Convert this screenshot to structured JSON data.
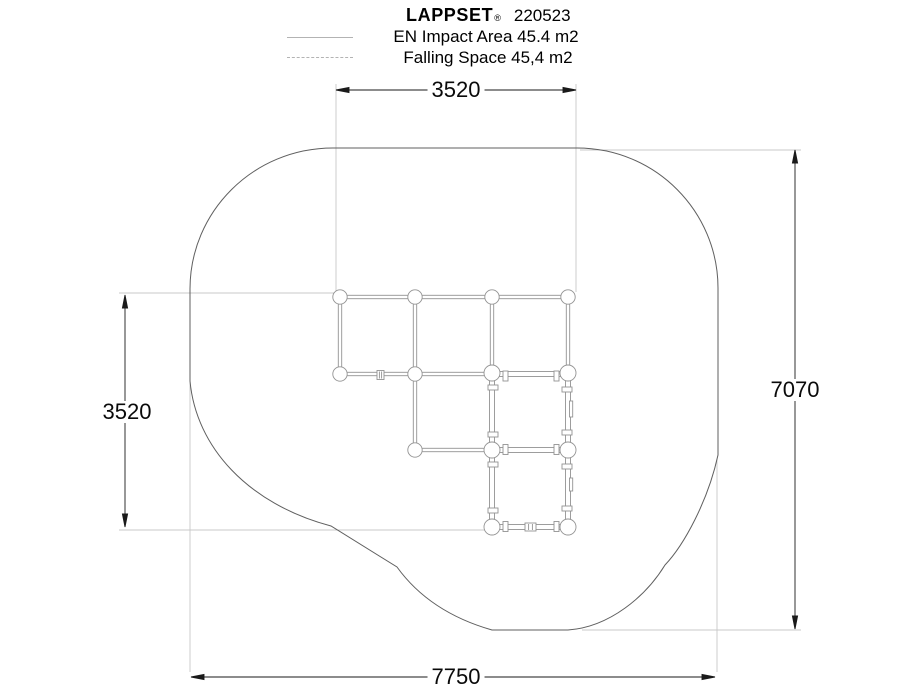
{
  "header": {
    "brand": "LAPPSET",
    "registered": "®",
    "product_number": "220523",
    "legend": [
      {
        "symbol": "solid-line",
        "label": "EN Impact Area 45.4 m2"
      },
      {
        "symbol": "dashed-line",
        "label": "Falling Space 45,4 m2"
      }
    ]
  },
  "dimensions": {
    "top": "3520",
    "left": "3520",
    "right": "7070",
    "bottom": "7750"
  },
  "drawing": {
    "type": "playground-equipment-plan-view",
    "outline_meaning": "EN Impact Area / Falling Space boundary",
    "structure": "climbing frame grid of posts and beams with two framed panels",
    "colors": {
      "background": "#ffffff",
      "outline": "#5f5f5f",
      "structure": "#939393",
      "dimension": "#1a1a1a",
      "extension": "#c8c8c8",
      "legend_line": "#b3b3b3"
    }
  }
}
